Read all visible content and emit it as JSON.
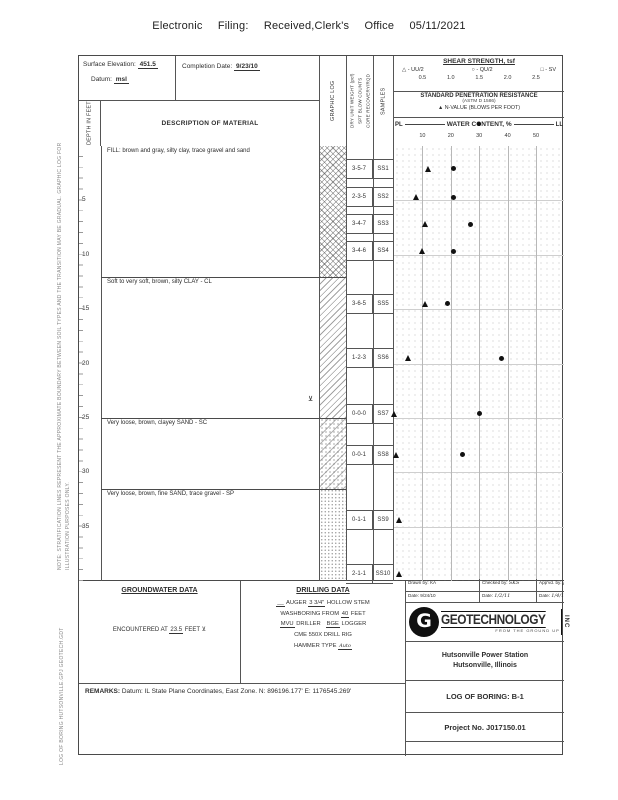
{
  "filing_header": "Electronic Filing: Received,Clerk's Office 05/11/2021",
  "side_notes": {
    "note": "NOTE: STRATIFICATION LINES REPRESENT THE APPROXIMATE BOUNDARY BETWEEN SOIL TYPES AND THE TRANSITION MAY BE GRADUAL.  GRAPHIC LOG FOR ILLUSTRATION PURPOSES ONLY.",
    "file_stamp": "LOG OF BORING  HUTSONVILLE.GPJ  GEOTECH.GDT"
  },
  "title_block": {
    "surface_elevation_label": "Surface Elevation:",
    "surface_elevation": "451.5",
    "datum_label": "Datum:",
    "datum": "msl",
    "completion_date_label": "Completion Date:",
    "completion_date": "9/23/10"
  },
  "columns": {
    "depth": "DEPTH IN FEET",
    "description": "DESCRIPTION OF MATERIAL",
    "graphic": "GRAPHIC LOG",
    "dry_unit_lines": [
      "DRY UNIT WEIGHT (pcf)",
      "SPT BLOW COUNTS",
      "CORE RECOVERY/RQD"
    ],
    "samples": "SAMPLES"
  },
  "chart_header": {
    "shear_title": "SHEAR STRENGTH, tsf",
    "shear_legend": [
      {
        "symbol": "△",
        "label": "- UU/2"
      },
      {
        "symbol": "○",
        "label": "- QU/2"
      },
      {
        "symbol": "□",
        "label": "- SV"
      }
    ],
    "shear_scale": [
      "0.5",
      "1.0",
      "1.5",
      "2.0",
      "2.5"
    ],
    "spr_title": "STANDARD PENETRATION RESISTANCE",
    "spr_subtitle": "(ASTM D 1586)",
    "spr_legend_symbol": "▲",
    "spr_legend_text": "N-VALUE (BLOWS PER FOOT)",
    "water_title": "WATER CONTENT, %",
    "pl_label": "PL",
    "ll_label": "LL",
    "water_scale": [
      "10",
      "20",
      "30",
      "40",
      "50"
    ]
  },
  "log": {
    "depth_ticks": [
      5,
      10,
      15,
      20,
      25,
      30,
      35
    ],
    "water_table_depth_ft": 23.5,
    "strata": [
      {
        "description": "FILL: brown and gray, silty clay, trace gravel and sand",
        "top_ft": 0,
        "bottom_ft": 12,
        "pattern": "fill"
      },
      {
        "description": "Soft to very soft, brown, silty CLAY - CL",
        "top_ft": 12,
        "bottom_ft": 25,
        "pattern": "clay"
      },
      {
        "description": "Very loose, brown, clayey SAND - SC",
        "top_ft": 25,
        "bottom_ft": 31.5,
        "pattern": "sc"
      },
      {
        "description": "Very loose, brown, fine SAND, trace gravel - SP",
        "top_ft": 31.5,
        "bottom_ft": 40,
        "pattern": "sp"
      }
    ],
    "samples": [
      {
        "id": "SS1",
        "blows": "3-5-7",
        "depth_ft": 2.1,
        "n_value": 12,
        "water_content_pct": 21
      },
      {
        "id": "SS2",
        "blows": "2-3-5",
        "depth_ft": 4.7,
        "n_value": 8,
        "water_content_pct": 21
      },
      {
        "id": "SS3",
        "blows": "3-4-7",
        "depth_ft": 7.2,
        "n_value": 11,
        "water_content_pct": 27
      },
      {
        "id": "SS4",
        "blows": "3-4-6",
        "depth_ft": 9.7,
        "n_value": 10,
        "water_content_pct": 21
      },
      {
        "id": "SS5",
        "blows": "3-6-5",
        "depth_ft": 14.5,
        "n_value": 11,
        "water_content_pct": 19
      },
      {
        "id": "SS6",
        "blows": "1-2-3",
        "depth_ft": 19.5,
        "n_value": 5,
        "water_content_pct": 38
      },
      {
        "id": "SS7",
        "blows": "0-0-0",
        "depth_ft": 24.6,
        "n_value": 0,
        "water_content_pct": 30
      },
      {
        "id": "SS8",
        "blows": "0-0-1",
        "depth_ft": 28.4,
        "n_value": 1,
        "water_content_pct": 24
      },
      {
        "id": "SS9",
        "blows": "0-1-1",
        "depth_ft": 34.4,
        "n_value": 2,
        "water_content_pct": null
      },
      {
        "id": "SS10",
        "blows": "2-1-1",
        "depth_ft": 39.4,
        "n_value": 2,
        "water_content_pct": null
      }
    ]
  },
  "chart_data": {
    "type": "scatter",
    "title": "STANDARD PENETRATION RESISTANCE / WATER CONTENT, %",
    "xlabel": "N-VALUE (blows per foot) and WATER CONTENT (%)",
    "ylabel": "DEPTH IN FEET",
    "xlim": [
      0,
      60
    ],
    "ylim": [
      0,
      40
    ],
    "grid": true,
    "series": [
      {
        "name": "N-VALUE (BLOWS PER FOOT)",
        "marker": "filled-triangle",
        "points": [
          [
            12,
            2.1
          ],
          [
            8,
            4.7
          ],
          [
            11,
            7.2
          ],
          [
            10,
            9.7
          ],
          [
            11,
            14.5
          ],
          [
            5,
            19.5
          ],
          [
            0,
            24.6
          ],
          [
            1,
            28.4
          ],
          [
            2,
            34.4
          ],
          [
            2,
            39.4
          ]
        ]
      },
      {
        "name": "WATER CONTENT, %",
        "marker": "filled-circle",
        "points": [
          [
            21,
            2.1
          ],
          [
            21,
            4.7
          ],
          [
            27,
            7.2
          ],
          [
            21,
            9.7
          ],
          [
            19,
            14.5
          ],
          [
            38,
            19.5
          ],
          [
            30,
            24.6
          ],
          [
            24,
            28.4
          ]
        ]
      }
    ]
  },
  "groundwater": {
    "title": "GROUNDWATER DATA",
    "encountered_prefix": "ENCOUNTERED AT",
    "encountered_depth": "23.5",
    "encountered_suffix": "FEET",
    "symbol": "⊻"
  },
  "drilling": {
    "title": "DRILLING DATA",
    "auger_blank": "__",
    "auger_label": "AUGER",
    "auger_size": "3 3/4\"",
    "auger_suffix": "HOLLOW STEM",
    "wash_prefix": "WASHBORING FROM",
    "wash_depth": "40",
    "wash_suffix": "FEET",
    "driller": "MVU",
    "driller_label": "DRILLER",
    "logger": "BGE",
    "logger_label": "LOGGER",
    "rig": "CME 550X DRILL RIG",
    "hammer_label": "HAMMER TYPE",
    "hammer_type": "Auto"
  },
  "remarks": {
    "label": "REMARKS:",
    "text": "Datum: IL State Plane Coordinates, East Zone.  N: 896196.177'  E: 1176545.269'"
  },
  "signoff": {
    "drawn_label": "Drawn by:",
    "drawn_by": "KA",
    "drawn_date_label": "Date:",
    "drawn_date": "9/24/10",
    "checked_label": "Checked by:",
    "checked_by": "SKS",
    "checked_date_label": "Date:",
    "checked_date": "1/2/11",
    "approved_label": "App'vd. by:",
    "approved_by": "JW",
    "approved_date_label": "Date:",
    "approved_date": "1/4/11"
  },
  "company": {
    "name": "GEOTECHNOLOGY",
    "suffix": "INC",
    "tagline": "FROM THE GROUND UP"
  },
  "project": {
    "station_line1": "Hutsonville Power Station",
    "station_line2": "Hutsonville, Illinois",
    "boring_label": "LOG OF BORING:",
    "boring_id": "B-1",
    "project_no_label": "Project No.",
    "project_no": "J017150.01"
  }
}
